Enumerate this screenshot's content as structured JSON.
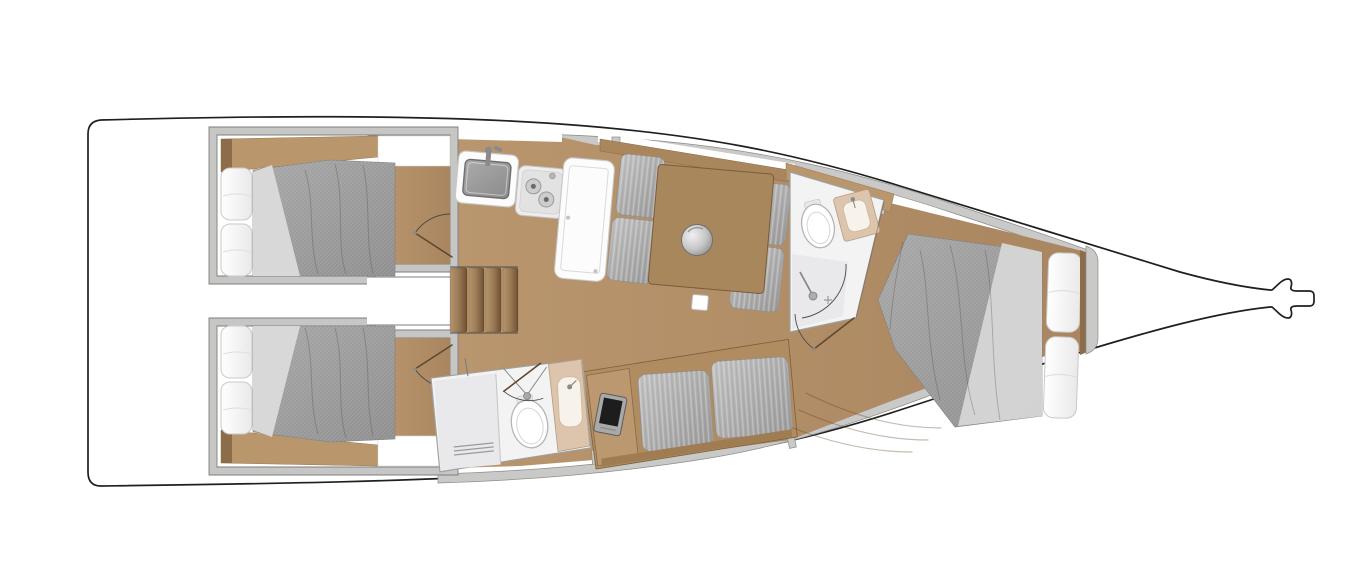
{
  "canvas": {
    "width": 1366,
    "height": 570
  },
  "colors": {
    "background": "#ffffff",
    "hull_line": "#1f1f1f",
    "deck_band": "#c9c9c7",
    "band_edge": "#8c8c8a",
    "wall_fill": "#c6c6c4",
    "wall_edge": "#7e7e7c",
    "floor_light": "#b9966e",
    "floor_dark": "#aa8660",
    "wood_shelf": "#b9966b",
    "wood_dark": "#8d6c49",
    "wood_panel": "#a9865c",
    "wood_table": "#a8875d",
    "wood_desk": "#bb9870",
    "wood_base": "#b08c60",
    "wood_backrest": "#9f7c52",
    "step_light": "#b5956d",
    "step_mid": "#9a7b55",
    "step_dark": "#6e5132",
    "mattress_light": "#a8a8a8",
    "mattress_dark": "#8f8f8f",
    "sheet": "#d8d8d8",
    "pillow_hi": "#ffffff",
    "pillow_lo": "#e9e9e9",
    "pillow_edge": "#c9c9c9",
    "cushion_light": "#c2c2c2",
    "cushion_dark": "#9a9a9a",
    "cushion_edge": "#8e8e8e",
    "unit_white": "#fcfcfc",
    "unit_edge": "#c8c8c8",
    "basin_light": "#ababab",
    "basin_dark": "#8b8b8b",
    "basin_edge": "#6f6f6f",
    "stove_body": "#ededed",
    "burner": "#cdcdcd",
    "burner_edge": "#9a9a9a",
    "burner_center": "#6a6a6a",
    "counter_tan": "#dcc5ac",
    "counter_tan_edge": "#b79c7e",
    "basin_tan": "#f7f2ea",
    "shower_floor": "#e9e9eb",
    "head_floor": "#f3f3f4",
    "head_edge": "#a0a09e",
    "drain": "#9a9a9a",
    "toilet": "#ffffff",
    "toilet_edge": "#b5b5b5",
    "toilet_inner": "#d5d5d5",
    "door_line": "#5d4930",
    "arc_line": "#4a4a4a",
    "laptop_body": "#a9a9a9",
    "laptop_screen": "#1d1d1d",
    "metal_light": "#f0f0f0",
    "metal_mid": "#c7c7c7",
    "metal_dark": "#8a8a8a",
    "fixture_gray": "#8a8a8a"
  },
  "diagram_data": {
    "type": "floor-plan",
    "subject": "sailing-yacht-interior-layout-top-view",
    "orientation": "bow-right-stern-left",
    "rooms": [
      {
        "id": "aft-cabin-port",
        "furniture": [
          "double-berth",
          "two-pillows",
          "wood-shelf",
          "side-cubby",
          "door-with-swing-arc"
        ]
      },
      {
        "id": "aft-cabin-starboard",
        "furniture": [
          "double-berth",
          "two-pillows",
          "wood-shelf",
          "side-cubby",
          "door-with-swing-arc"
        ]
      },
      {
        "id": "companionway",
        "furniture": [
          "landing",
          "stairs-4-steps"
        ]
      },
      {
        "id": "galley",
        "furniture": [
          "sink-with-faucet",
          "two-burner-stove",
          "refrigerator-counter"
        ]
      },
      {
        "id": "salon",
        "furniture": [
          "port-settee-4-cushions",
          "dining-table",
          "round-pedestal",
          "mast-foot-square"
        ]
      },
      {
        "id": "chart-station",
        "furniture": [
          "desk",
          "chartplotter"
        ]
      },
      {
        "id": "starboard-settee",
        "furniture": [
          "two-long-cushions",
          "wood-backrest"
        ]
      },
      {
        "id": "aft-head",
        "furniture": [
          "shower-with-drain",
          "toilet",
          "washbasin-tan-counter",
          "shower-fixture",
          "door-with-swing-arc"
        ]
      },
      {
        "id": "forward-head",
        "furniture": [
          "toilet",
          "washbasin-tan-counter",
          "shower-corner",
          "door-with-swing-arc"
        ]
      },
      {
        "id": "forward-cabin",
        "furniture": [
          "island-berth",
          "two-pillows",
          "headboard",
          "floor-steps"
        ]
      },
      {
        "id": "bow",
        "furniture": [
          "anchor-fitting"
        ]
      }
    ]
  }
}
